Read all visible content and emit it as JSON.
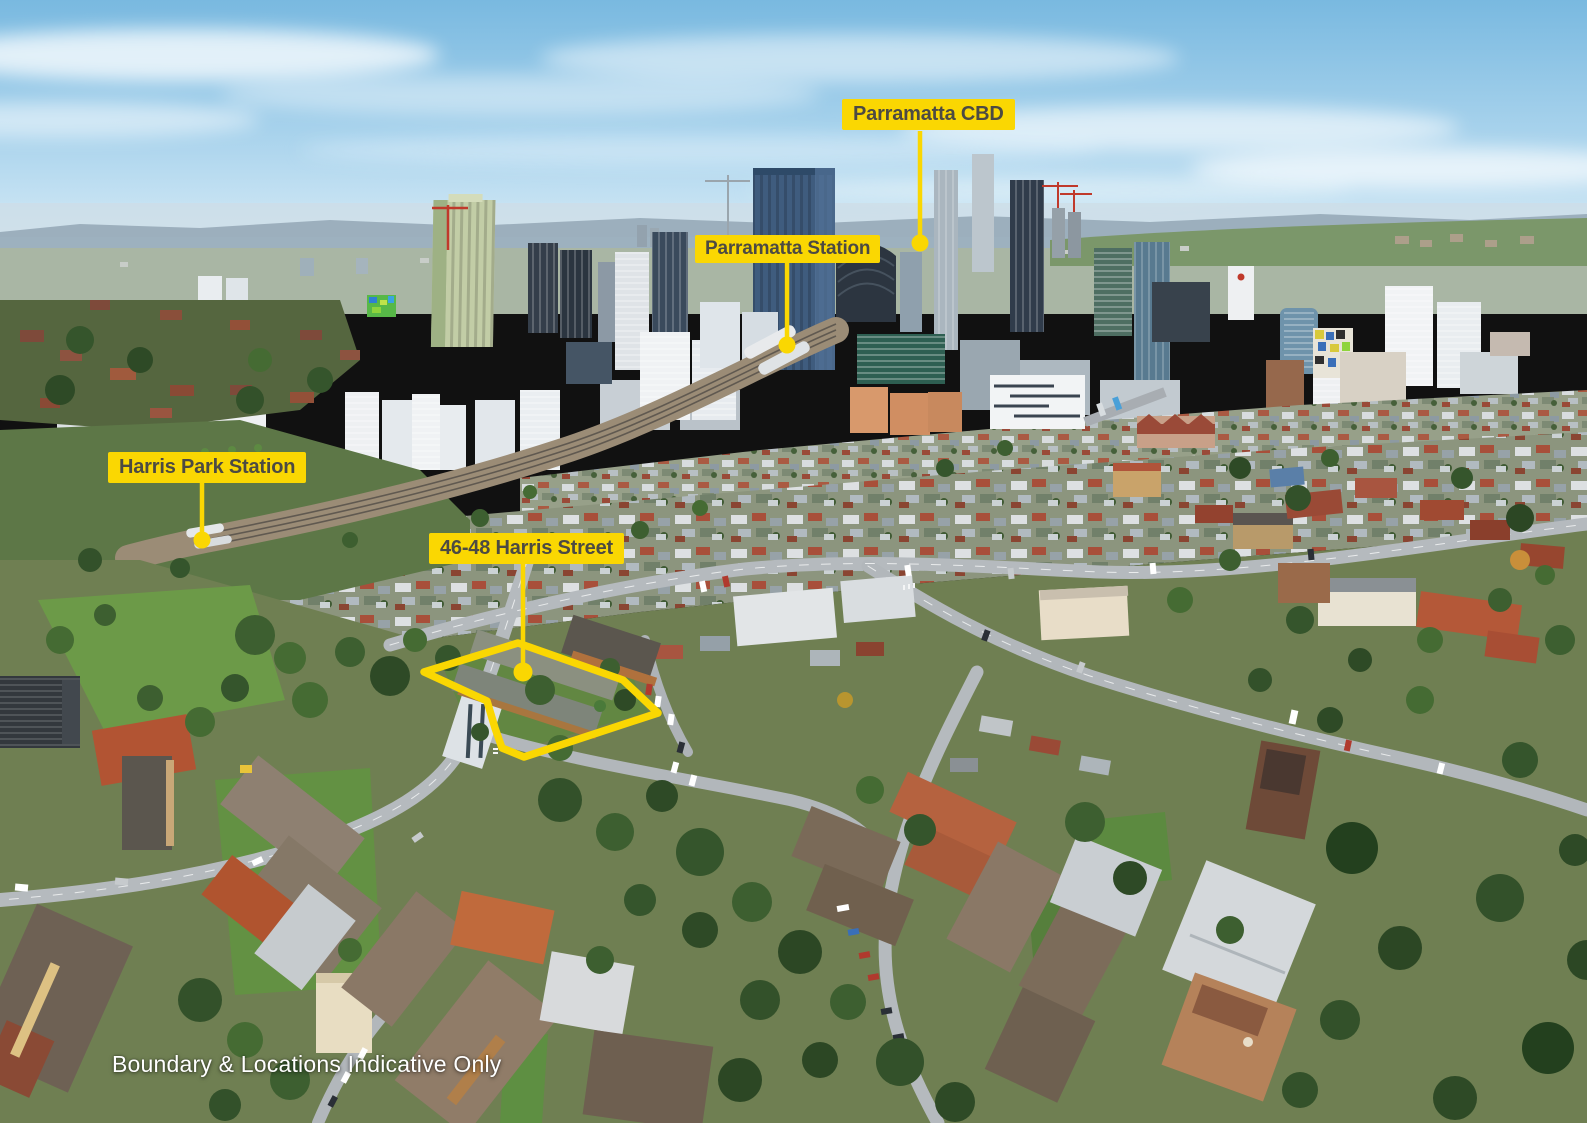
{
  "annotations": {
    "labels": [
      {
        "id": "parramatta-cbd",
        "text": "Parramatta CBD"
      },
      {
        "id": "parramatta-station",
        "text": "Parramatta Station"
      },
      {
        "id": "harris-park-station",
        "text": "Harris Park Station"
      },
      {
        "id": "subject-property",
        "text": "46-48 Harris Street"
      }
    ],
    "disclaimer": "Boundary & Locations Indicative Only",
    "boundary_points": "518,643 623,680 658,713 524,757 502,748 495,728 487,701 424,672",
    "colors": {
      "callout_background": "#FAD702",
      "callout_text": "#4C4A43",
      "boundary_line": "#FAD702",
      "disclaimer_text": "#FFFFFF"
    }
  }
}
